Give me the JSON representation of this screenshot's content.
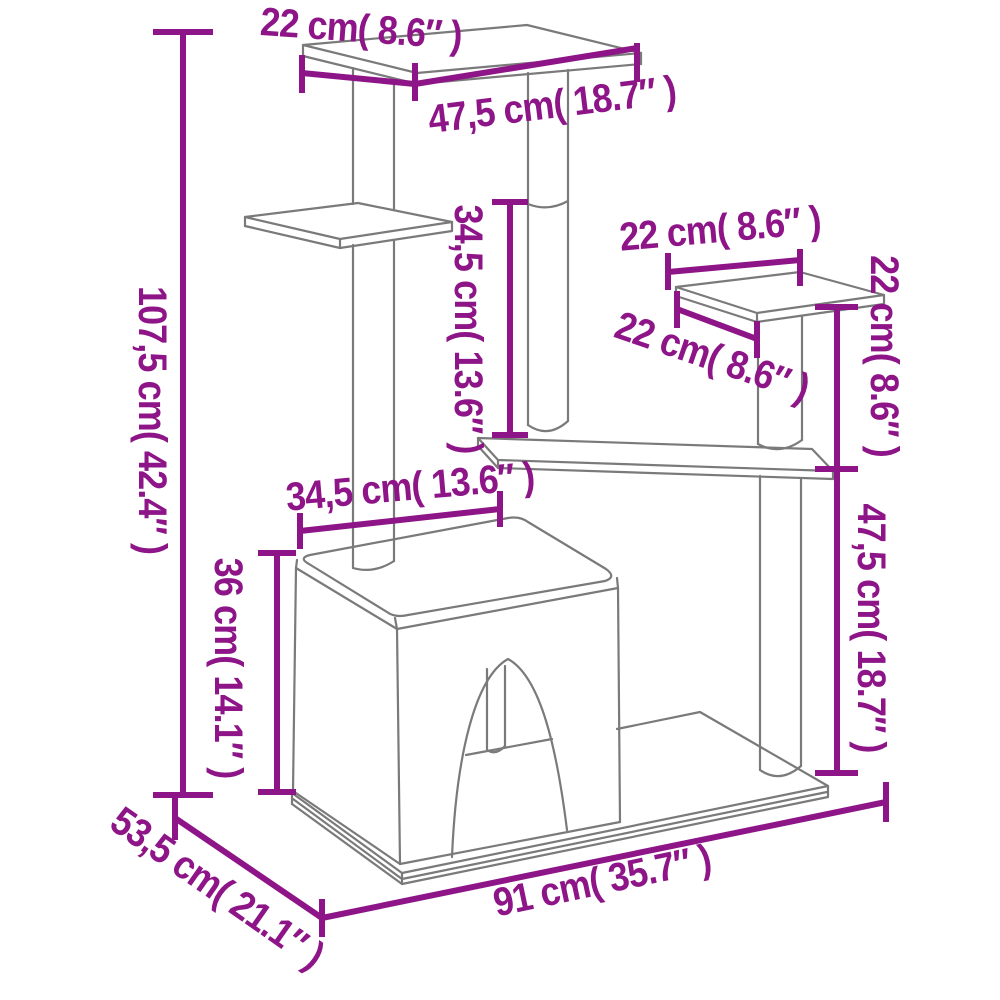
{
  "diagram": {
    "product": "Cat tree with scratching posts and cat house",
    "style": {
      "accent_color": "#8E1588",
      "line_color": "#7A7A7A",
      "background": "#FFFFFF"
    },
    "dimensions": [
      {
        "id": "total-height",
        "cm": 107.5,
        "inch": 42.4,
        "label": "107,5 cm( 42.4″ )"
      },
      {
        "id": "top-platform-depth",
        "cm": 22,
        "inch": 8.6,
        "label": "22 cm( 8.6″ )"
      },
      {
        "id": "top-platform-width",
        "cm": 47.5,
        "inch": 18.7,
        "label": "47,5 cm( 18.7″ )"
      },
      {
        "id": "middle-post-height",
        "cm": 34.5,
        "inch": 13.6,
        "label": "34,5 cm( 13.6″ )"
      },
      {
        "id": "side-platform-width",
        "cm": 22,
        "inch": 8.6,
        "label": "22 cm( 8.6″ )"
      },
      {
        "id": "side-platform-depth",
        "cm": 22,
        "inch": 8.6,
        "label": "22 cm( 8.6″ )"
      },
      {
        "id": "side-post-height",
        "cm": 22,
        "inch": 8.6,
        "label": "22 cm( 8.6″ )"
      },
      {
        "id": "house-roof-width",
        "cm": 34.5,
        "inch": 13.6,
        "label": "34,5 cm( 13.6″ )"
      },
      {
        "id": "house-height",
        "cm": 36,
        "inch": 14.1,
        "label": "36 cm( 14.1″ )"
      },
      {
        "id": "lower-post-height",
        "cm": 47.5,
        "inch": 18.7,
        "label": "47,5 cm( 18.7″ )"
      },
      {
        "id": "base-depth",
        "cm": 53.5,
        "inch": 21.1,
        "label": "53,5 cm( 21.1″ )"
      },
      {
        "id": "base-width",
        "cm": 91,
        "inch": 35.7,
        "label": "91 cm( 35.7″ )"
      }
    ]
  }
}
